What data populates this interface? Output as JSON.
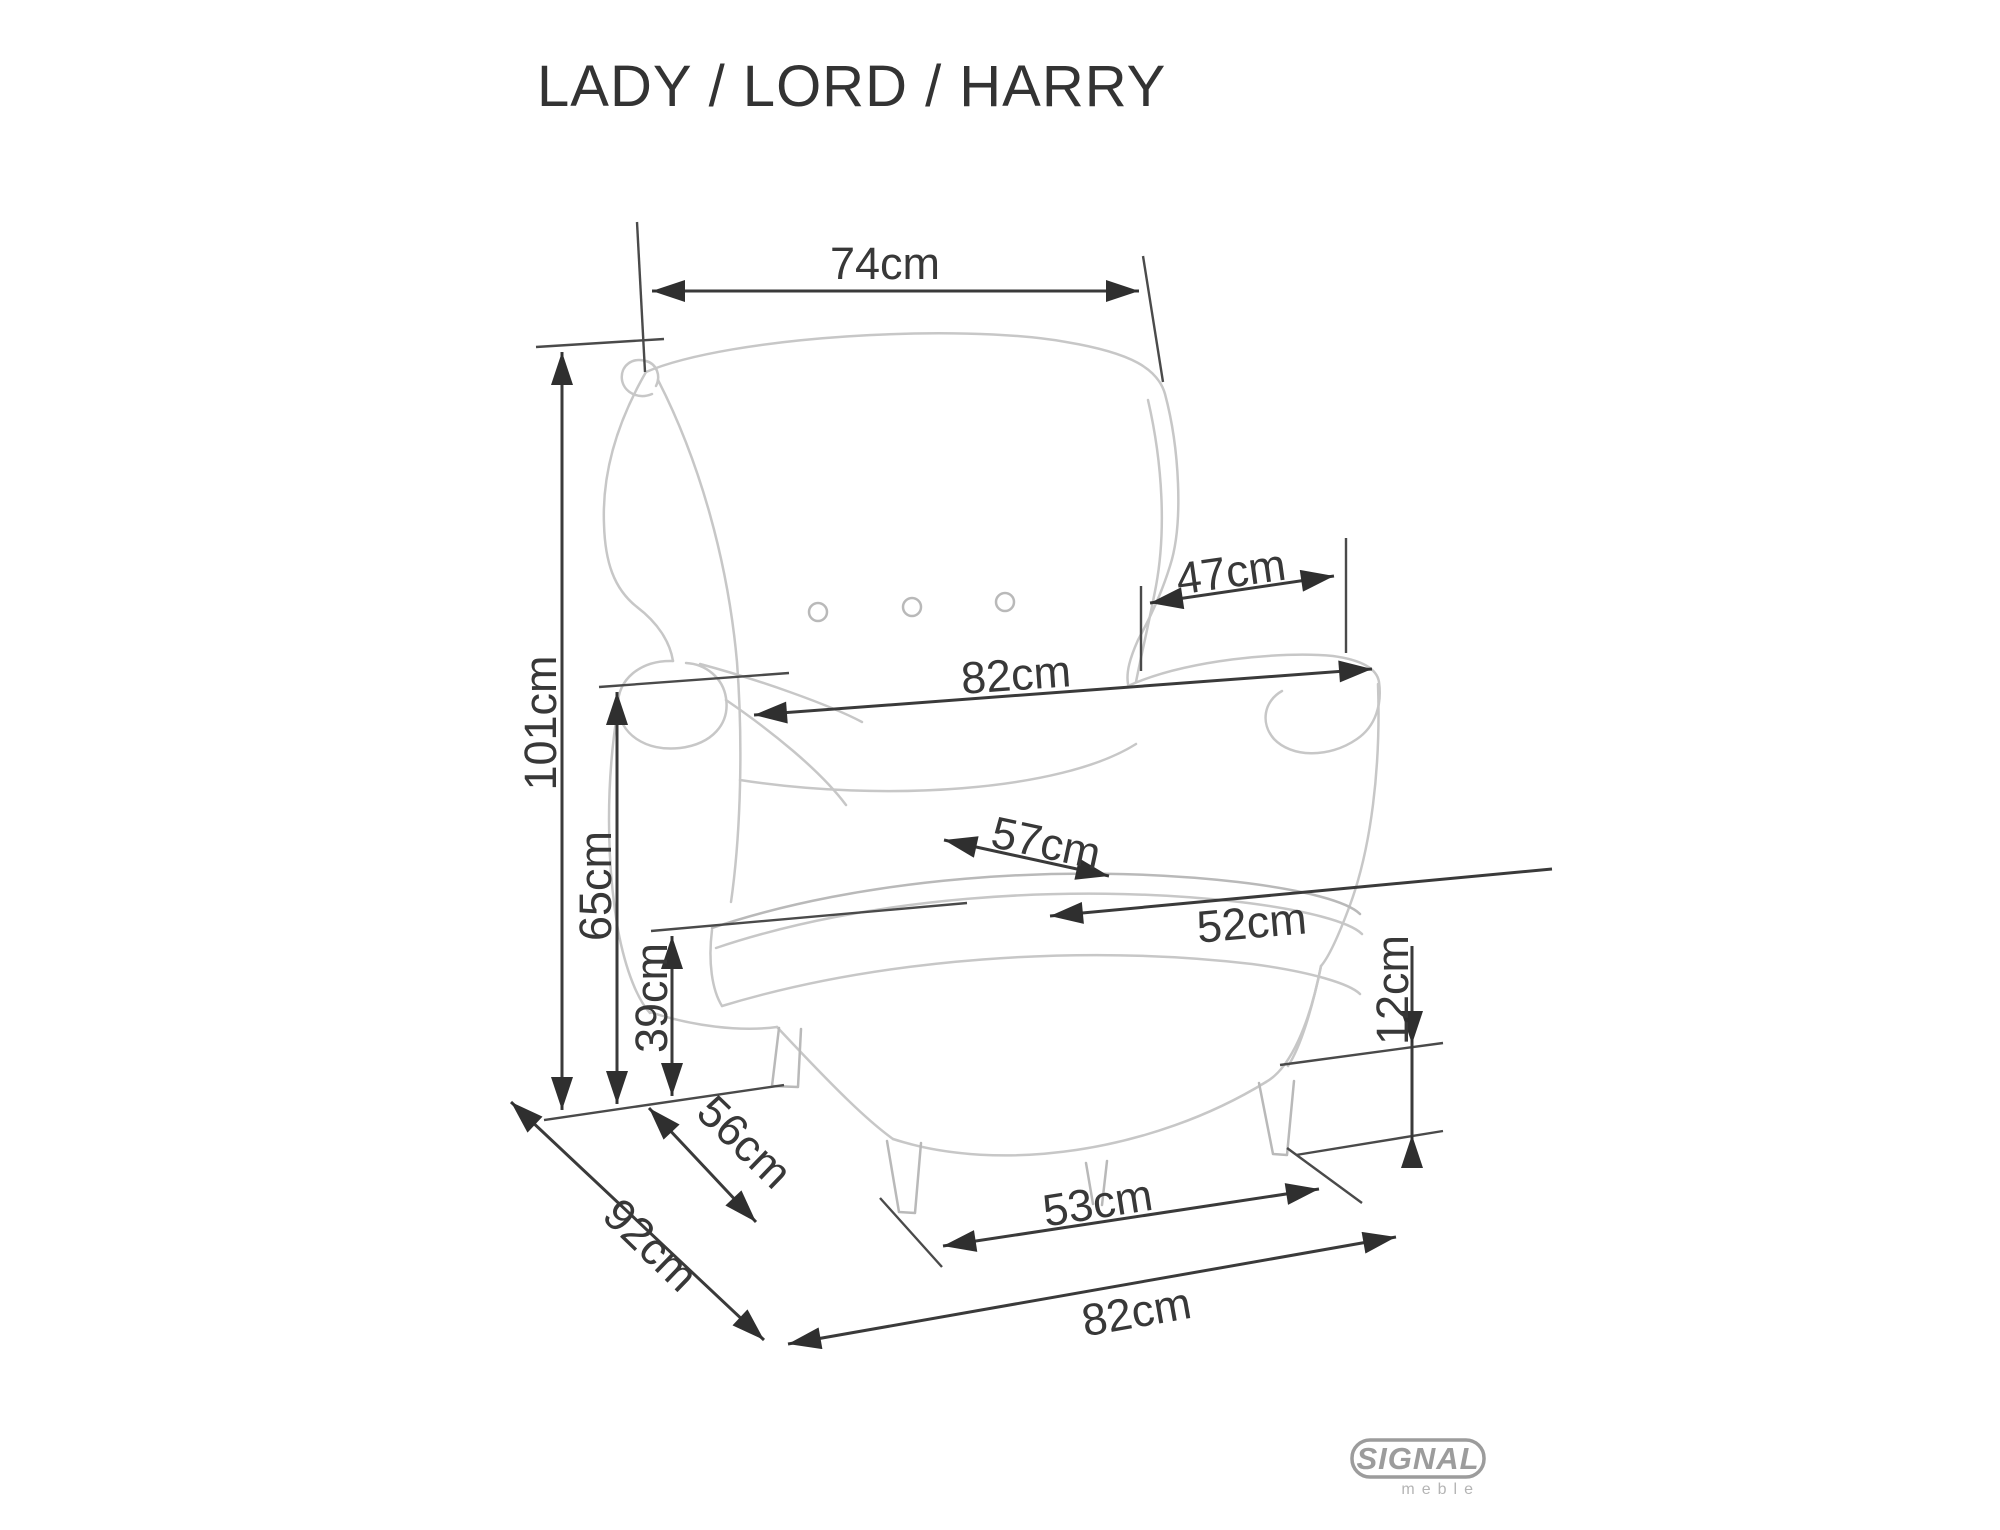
{
  "title": "LADY / LORD / HARRY",
  "product_models": [
    "LADY",
    "LORD",
    "HARRY"
  ],
  "unit": "cm",
  "dims": {
    "d74": "74cm",
    "d101": "101cm",
    "d65": "65cm",
    "d39": "39cm",
    "d56": "56cm",
    "d92": "92cm",
    "d53": "53cm",
    "d82_bottom": "82cm",
    "d12": "12cm",
    "d47": "47cm",
    "d82_mid": "82cm",
    "d57": "57cm",
    "d52": "52cm"
  },
  "dimensions_cm": {
    "backrest_top_width": 74,
    "total_height": 101,
    "armrest_height": 65,
    "seat_height": 39,
    "seat_depth_diagonal": 56,
    "total_depth": 92,
    "front_leg_spacing": 53,
    "total_width": 82,
    "leg_height": 12,
    "armrest_length": 47,
    "width_over_armrests": 82,
    "seat_width": 57,
    "seat_depth": 52
  },
  "logo": {
    "brand": "SIGNAL",
    "sub": "meble"
  },
  "colors": {
    "dimension_lines": "#3a3a3a",
    "sketch_lines": "#c7c7c7",
    "logo_gray": "#9c9c9c",
    "background": "#ffffff"
  }
}
